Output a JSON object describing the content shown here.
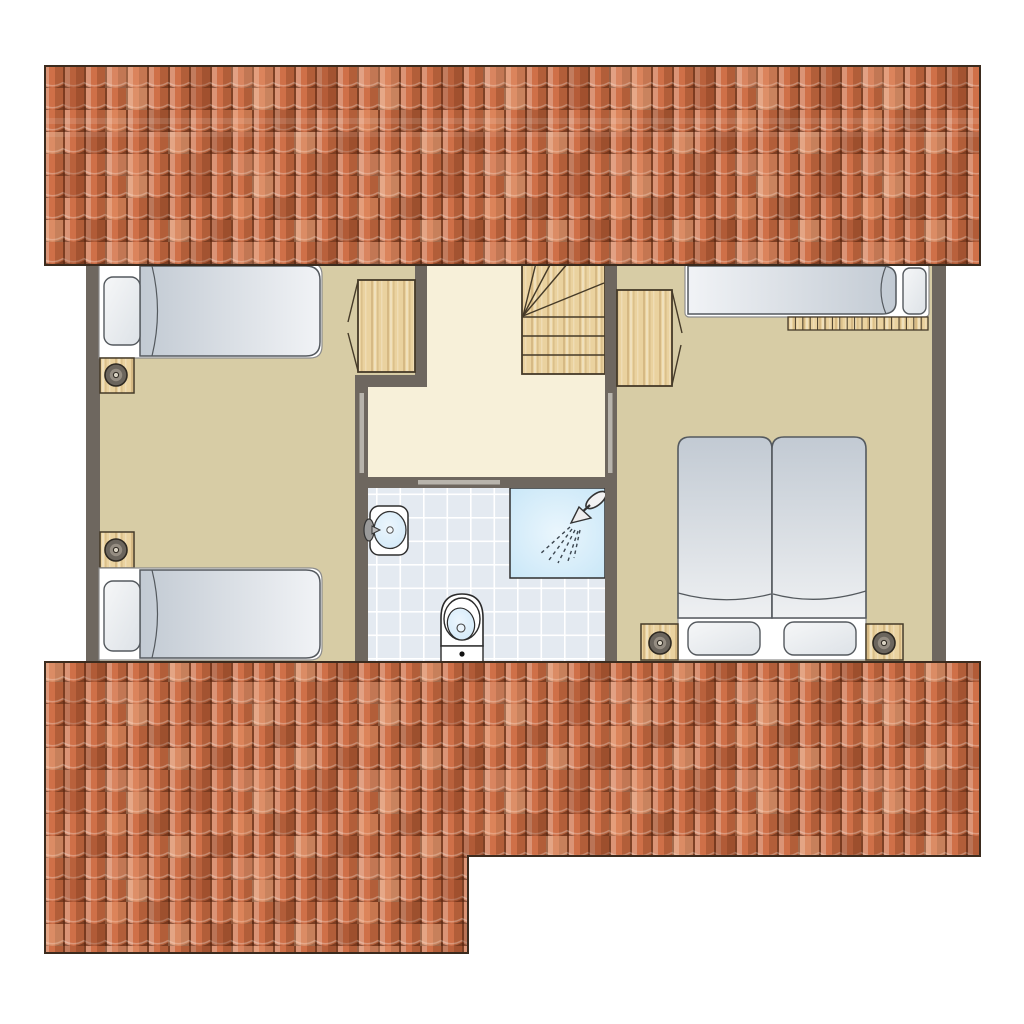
{
  "plan": {
    "kind": "residential-upper-floor-plan",
    "objects": [
      "roof-band-top",
      "roof-band-bottom",
      "bedroom-left",
      "hallway-landing",
      "bathroom",
      "bedroom-right",
      "staircase-winder",
      "single-bed-top-left",
      "single-bed-bottom-left",
      "single-bed-right",
      "double-bed",
      "wardrobe-left",
      "wardrobe-right",
      "nightstand-lamp-x4",
      "washbasin",
      "toilet",
      "shower",
      "radiator-slats",
      "door-opening-x3"
    ]
  },
  "palette": {
    "roofBase": "#cf7048",
    "roofOutline": "#3b2b1e",
    "wall": "#6e675f",
    "floorTan": "#d7cca5",
    "floorCream": "#f7f0d9",
    "wood": "#ead29f",
    "woodOutline": "#453a28",
    "bathFloor": "#e4eaf1",
    "tileLine": "#ffffff",
    "showerBlue": "#c7e6f7",
    "showerGlow": "#eaf6fd",
    "fixtureBlue": "#cfe8f8",
    "fixtureBlueLight": "#ecf6fd",
    "bedLight": "#f1f3f6",
    "bedDark": "#c2cad3",
    "pillowLight": "#f6f7f8",
    "pillowDark": "#dde2e7",
    "outlineGray": "#54595e",
    "frameWhite": "#ffffff",
    "frameStroke": "#8c8c8c",
    "doorMarker": "#b8b4ac",
    "lampOuter": "#6b655d",
    "lampMid": "#958d82",
    "lampDot": "#d9d2c2",
    "iconDark": "#333333",
    "spray": "#3c4650"
  }
}
